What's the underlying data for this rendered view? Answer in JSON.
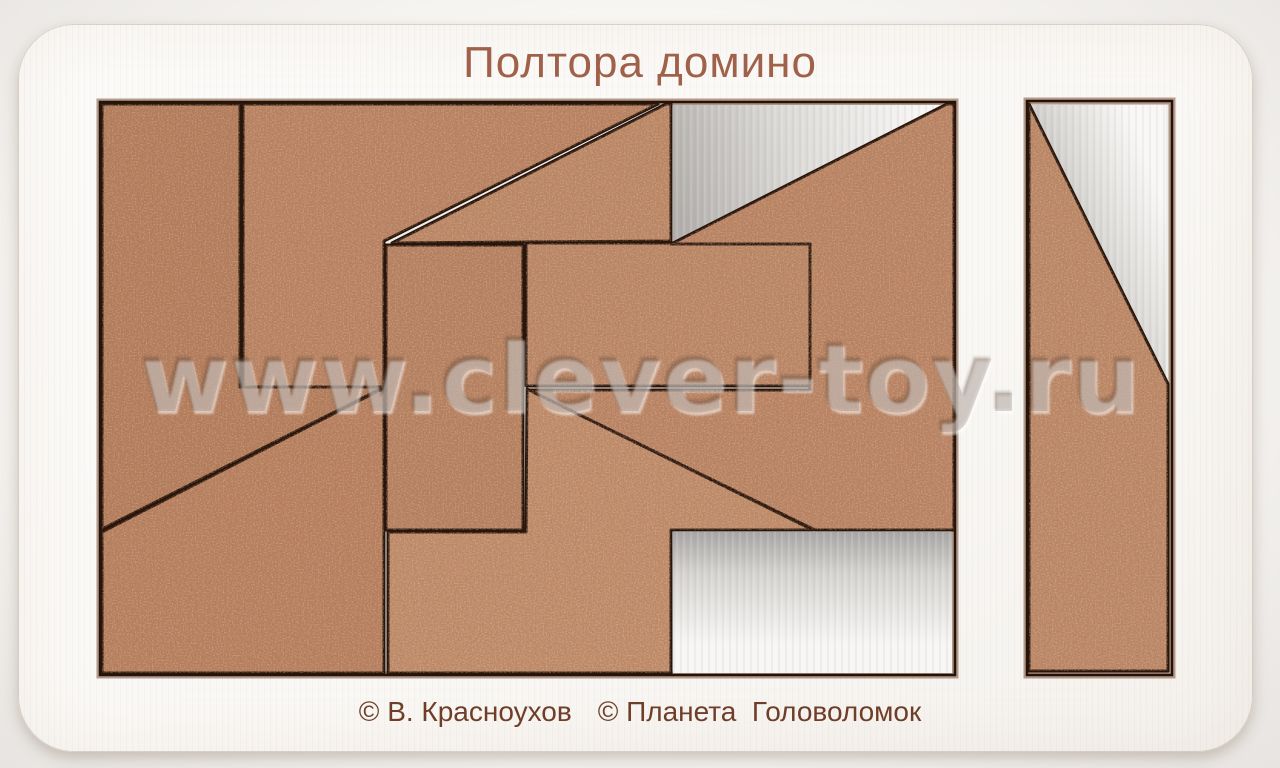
{
  "title": "Полтора домино",
  "credits": {
    "author": "© В. Красноухов",
    "publisher": "© Планета  Головоломок"
  },
  "watermark": "www.clever-toy.ru",
  "colors": {
    "backdrop": "#e9e7e4",
    "board": "#fbfaf8",
    "tray_floor": "#efedea",
    "tray_burn_edge": "#7a4f35",
    "cut_line": "#241208",
    "piece_stroke": "#2a150b",
    "title_text": "#a0614a",
    "credits_text": "#6e3e28",
    "wood_base": "#ba8261",
    "wood_speckle_dark": "#57311a",
    "wood_speckle_light": "#f2d4af"
  },
  "board": {
    "x": 18,
    "y": 24,
    "w": 1235,
    "h": 728,
    "radius": 56
  },
  "trays": [
    {
      "name": "main-tray",
      "x": 100,
      "y": 102,
      "w": 855,
      "h": 573
    },
    {
      "name": "side-tray",
      "x": 1027,
      "y": 101,
      "w": 145,
      "h": 574
    }
  ],
  "pieces": [
    {
      "name": "piece-left-hook",
      "fill": "#b47b5a",
      "points": "102,104 240,104 240,387 384,387 102,529"
    },
    {
      "name": "piece-top-pentagon",
      "fill": "#ba8161",
      "points": "243,104 658,104 384,241 384,387 243,387"
    },
    {
      "name": "piece-small-triangle",
      "fill": "#bd8765",
      "points": "666,104 671,104 671,241 392,243"
    },
    {
      "name": "piece-middle-rect",
      "fill": "#bc8666",
      "points": "526,243 811,243 811,386 526,386"
    },
    {
      "name": "piece-tall-rect",
      "fill": "#b78060",
      "points": "386,245 523,245 523,530 386,530"
    },
    {
      "name": "piece-big-flag",
      "fill": "#bb8363",
      "points": "947,104 954,104 954,530 815,530 529,390 810,390 810,244 671,244"
    },
    {
      "name": "piece-bottom-left-quad",
      "fill": "#b87e5d",
      "points": "102,532 380,390 384,390 384,673 102,673"
    },
    {
      "name": "piece-bottom-boot",
      "fill": "#c18b69",
      "points": "527,389 813,530 671,530 671,673 388,673 388,532 526,532"
    },
    {
      "name": "piece-side-bar",
      "fill": "#bd8766",
      "points": "1029,104 1168,384 1168,671 1029,671"
    }
  ],
  "empty_slots": [
    {
      "name": "empty-top-right-triangle",
      "gradient": "gradTopTri",
      "points": "673,105 944,105 673,241"
    },
    {
      "name": "empty-bottom-right-rect",
      "gradient": "gradBotRect",
      "points": "673,532 952,532 952,673 673,673"
    },
    {
      "name": "empty-side-tray-triangle",
      "gradient": "gradSideTri",
      "points": "1031,105 1166,105 1166,380"
    }
  ]
}
